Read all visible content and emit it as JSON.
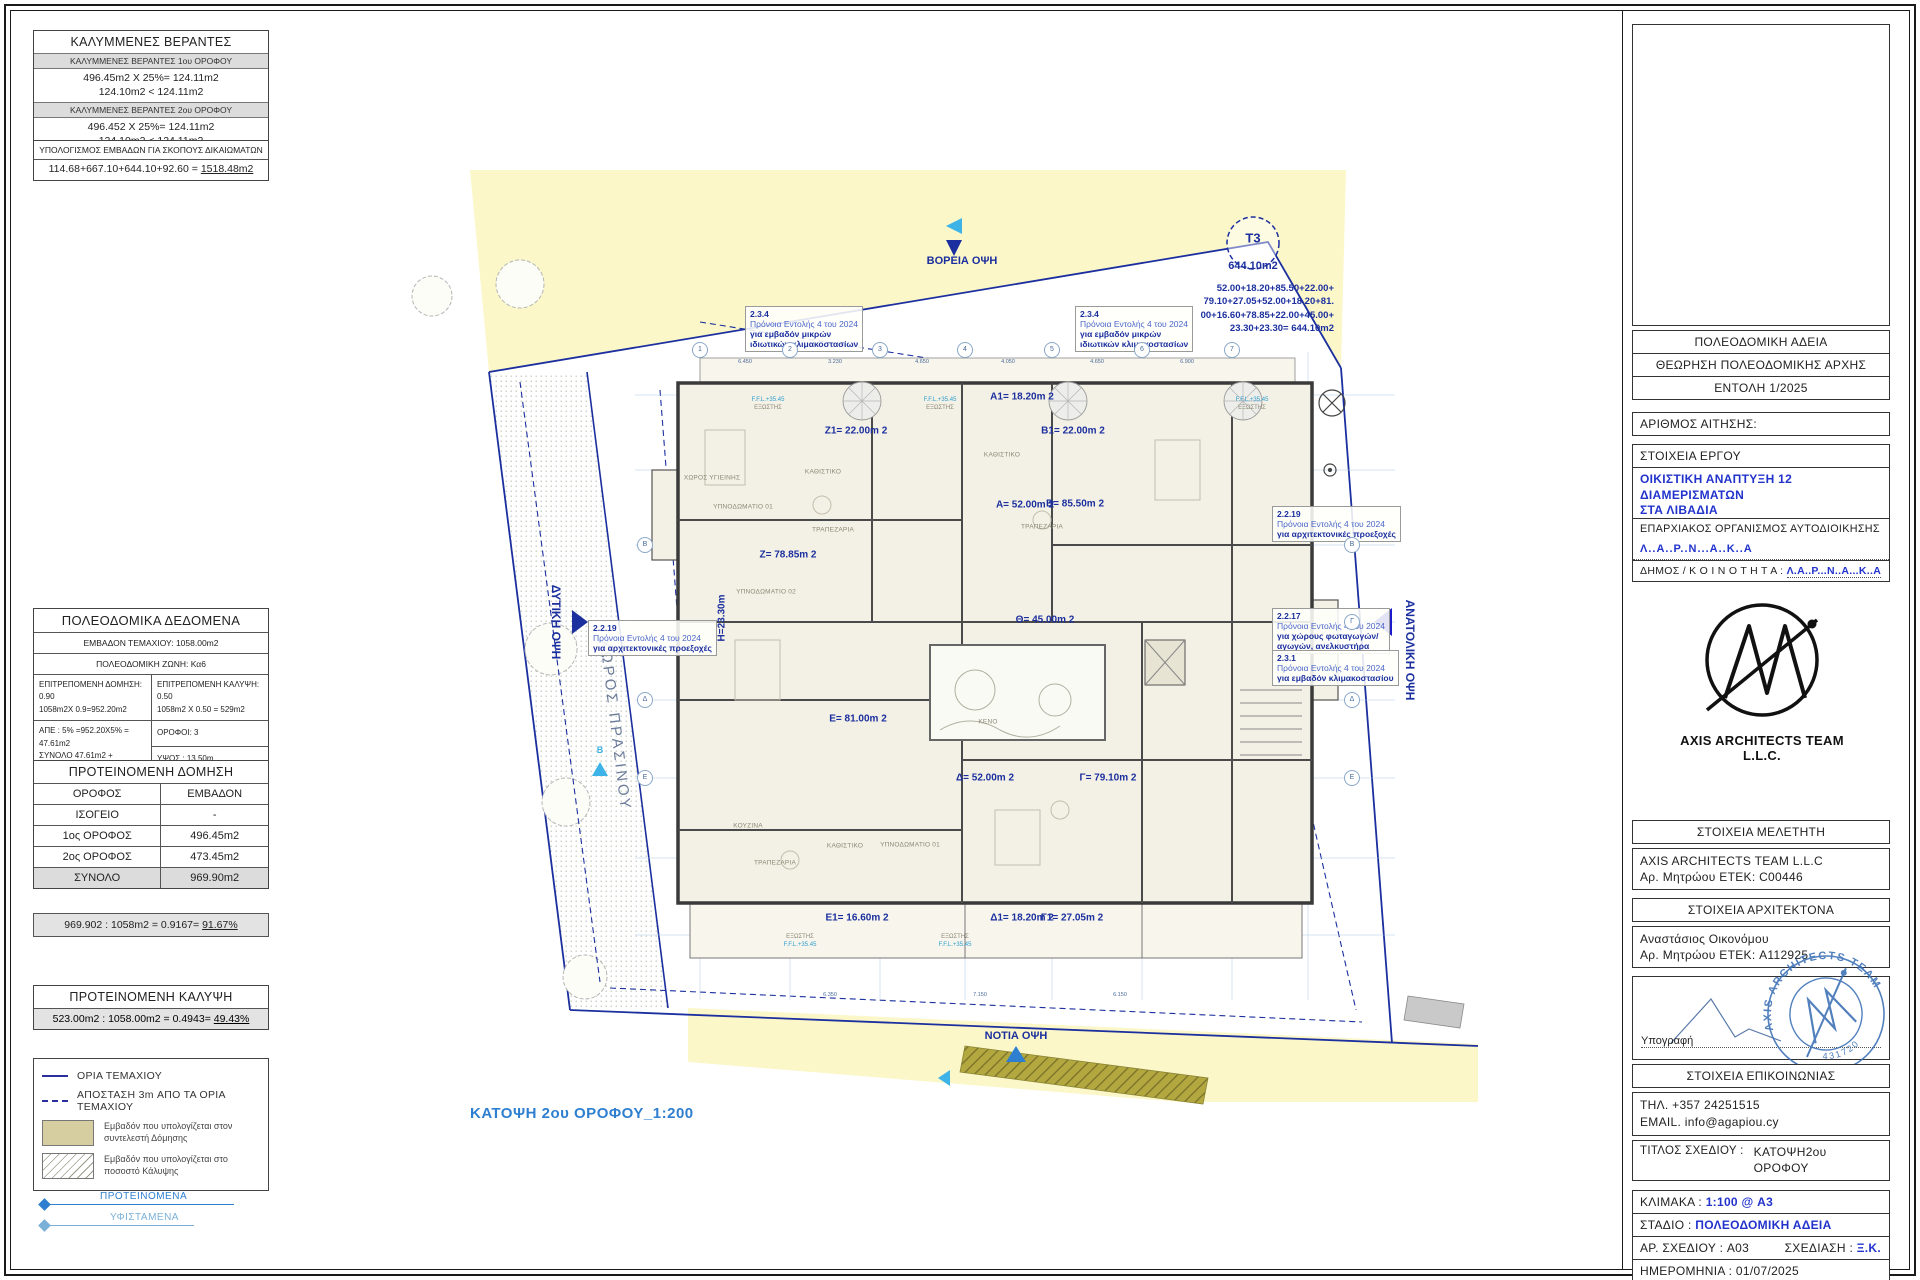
{
  "colors": {
    "navy": "#1b2f9e",
    "accent_blue": "#2233cc",
    "light_blue": "#2e7fd0",
    "cyan": "#3db3e8",
    "parcel_yellow": "#fbf7c9",
    "legend_tan": "#d6cda0",
    "header_gray": "#dcdcdc"
  },
  "left_panel": {
    "verandas": {
      "title": "ΚΑΛΥΜΜΕΝΕΣ ΒΕΡΑΝΤΕΣ",
      "s1_header": "ΚΑΛΥΜΜΕΝΕΣ ΒΕΡΑΝΤΕΣ 1ου ΟΡΟΦΟΥ",
      "s1_line1": "496.45m2 X 25%= 124.11m2",
      "s1_line2": "124.10m2 < 124.11m2",
      "s2_header": "ΚΑΛΥΜΜΕΝΕΣ ΒΕΡΑΝΤΕΣ 2ου ΟΡΟΦΟΥ",
      "s2_line1": "496.452 X 25%= 124.11m2",
      "s2_line2": "124.10m2 < 124.11m2"
    },
    "rights": {
      "title": "ΥΠΟΛΟΓΙΣΜΟΣ ΕΜΒΑΔΩΝ ΓΙΑ ΣΚΟΠΟΥΣ ΔΙΚΑΙΩΜΑΤΩΝ",
      "formula": "114.68+667.10+644.10+92.60 = ",
      "result": "1518.48m2"
    },
    "planning": {
      "title": "ΠΟΛΕΟΔΟΜΙΚΑ ΔΕΔΟΜΕΝΑ",
      "plot_area": "ΕΜΒΑΔΟΝ ΤΕΜΑΧΙΟΥ: 1058.00m2",
      "zone": "ΠΟΛΕΟΔΟΜΙΚΗ ΖΩΝΗ: Κα6",
      "density_title": "ΕΠΙΤΡΕΠΟΜΕΝΗ ΔΟΜΗΣΗ: 0.90",
      "density_calc": "1058m2X 0.9=952.20m2",
      "coverage_title": "ΕΠΙΤΡΕΠΟΜΕΝΗ ΚΑΛΥΨΗ: 0.50",
      "coverage_calc": "1058m2 X 0.50 = 529m2",
      "ape": "ΑΠΕ : 5% =952.20X5% = 47.61m2",
      "total_pre": "ΣΥΝΟΛΟ 47.61m2 + 952.20m2=",
      "total_result": "999.81m2",
      "floors": "ΟΡΟΦΟΙ: 3",
      "height": "ΥΨΟΣ : 13.50m"
    },
    "proposed_density": {
      "title": "ΠΡΟΤΕΙΝΟΜΕΝΗ ΔΟΜΗΣΗ",
      "col_floor": "ΟΡΟΦΟΣ",
      "col_area": "ΕΜΒΑΔΟΝ",
      "r1_floor": "ΙΣΟΓΕΙΟ",
      "r1_area": "-",
      "r2_floor": "1ος ΟΡΟΦΟΣ",
      "r2_area": "496.45m2",
      "r3_floor": "2ος ΟΡΟΦΟΣ",
      "r3_area": "473.45m2",
      "r4_floor": "ΣΥΝΟΛΟ",
      "r4_area": "969.90m2"
    },
    "density_ratio": {
      "formula": "969.902 : 1058m2 = 0.9167= ",
      "result": "91.67%"
    },
    "coverage": {
      "title": "ΠΡΟΤΕΙΝΟΜΕΝΗ ΚΑΛΥΨΗ",
      "formula": "523.00m2 : 1058.00m2 = 0.4943= ",
      "result": "49.43%"
    },
    "legend": {
      "boundary": "ΟΡΙΑ ΤΕΜΑΧΙΟΥ",
      "offset": "ΑΠΟΣΤΑΣΗ 3m ΑΠΟ ΤΑ ΟΡΙΑ ΤΕΜΑΧΙΟΥ",
      "density_l1": "Εμβαδόν που υπολογίζεται στον",
      "density_l2": "συντελεστή Δόμησης",
      "coverage_l1": "Εμβαδόν που υπολογίζεται στο",
      "coverage_l2": "ποσοστό Κάλυψης",
      "proposed": "ΠΡΟΤΕΙΝΟΜΕΝΑ",
      "existing": "ΥΦΙΣΤΑΜΕΝΑ"
    }
  },
  "drawing": {
    "caption": "ΚΑΤΟΨΗ 2ου ΟΡΟΦΟΥ_1:200",
    "north": "ΒΟΡΕΙΑ ΟΨΗ",
    "south": "ΝΟΤΙΑ ΟΨΗ",
    "west": "ΔΥΤΙΚΗ ΟΨΗ",
    "east": "ΑΝΑΤΟΛΙΚΗ ΟΨΗ",
    "green": "ΧΩΡΟΣ ΠΡΑΣΙΝΟΥ",
    "b_marker": "B",
    "t3": {
      "code": "T3",
      "area": "644.10m2",
      "sum1": "52.00+18.20+85.50+22.00+",
      "sum2": "79.10+27.05+52.00+18.20+81.",
      "sum3": "00+16.60+78.85+22.00+45.00+",
      "sum4": "23.30+23.30= 644.10m2"
    },
    "notes": {
      "n234": {
        "code": "2.3.4",
        "l1": "Πρόνοια Εντολής 4 του 2024",
        "l2": "για εμβαδόν μικρών",
        "l3": "ιδιωτικών κλιμακοστασίων"
      },
      "n2219": {
        "code": "2.2.19",
        "l1": "Πρόνοια Εντολής 4 του 2024",
        "l2": "για αρχιτεκτονικές προεξοχές"
      },
      "n2217": {
        "code": "2.2.17",
        "l1": "Πρόνοια Εντολής 4 του 2024",
        "l2": "για χώρους φωταγωγών/",
        "l3": "αγωγών, ανελκυστήρα"
      },
      "n231": {
        "code": "2.3.1",
        "l1": "Πρόνοια Εντολής 4 του 2024",
        "l2": "για εμβαδόν κλιμακοστασίου"
      }
    },
    "apartments": {
      "z1": "Z1= 22.00m 2",
      "a1": "A1= 18.20m 2",
      "b1": "B1= 22.00m 2",
      "a": "A= 52.00m 2",
      "b": "B= 85.50m 2",
      "z": "Z= 78.85m 2",
      "h": "Η=23.30m",
      "theta": "Θ= 45.00m 2",
      "e": "E= 81.00m 2",
      "d": "Δ= 52.00m 2",
      "g": "Γ= 79.10m 2",
      "e1": "E1= 16.60m 2",
      "d1": "Δ1= 18.20m 2",
      "g1": "Γ1= 27.05m 2"
    },
    "rooms": [
      "ΚΑΘΙΣΤΙΚΟ",
      "ΤΡΑΠΕΖΑΡΙΑ",
      "ΥΠΝΟΔΩΜΑΤΙΟ 01",
      "ΧΩΡΟΣ ΥΓΙΕΙΝΗΣ",
      "ΚΑΘΙΣΤΙΚΟ",
      "ΤΡΑΠΕΖΑΡΙΑ",
      "ΥΠΝΟΔΩΜΑΤΙΟ 02",
      "ΚΟΥΖΙΝΑ",
      "ΤΡΑΠΕΖΑΡΙΑ",
      "ΚΑΘΙΣΤΙΚΟ",
      "ΥΠΝΟΔΩΜΑΤΙΟ 01",
      "ΚΕΝΟ"
    ],
    "ffl": "F.F.L.+35.45",
    "balcony": "ΕΞΩΣΤΗΣ",
    "axes_top": [
      "1",
      "2",
      "3",
      "4",
      "5",
      "6",
      "7"
    ],
    "axes_side": [
      "Β",
      "Γ",
      "Δ",
      "Ε"
    ],
    "dims_top": [
      "6.450",
      "3.230",
      "4.650",
      "4.050",
      "4.650",
      "6.900"
    ],
    "dims_bottom": [
      "6.350",
      "7.150",
      "6.150"
    ]
  },
  "title_block": {
    "permit": "ΠΟΛΕΟΔΟΜΙΚΗ ΑΔΕΙΑ",
    "review": "ΘΕΩΡΗΣΗ ΠΟΛΕΟΔΟΜΙΚΗΣ ΑΡΧΗΣ",
    "order": "ΕΝΤΟΛΗ 1/2025",
    "application": "ΑΡΙΘΜΟΣ ΑΙΤΗΣΗΣ:",
    "project_header": "ΣΤΟΙΧΕΙΑ ΕΡΓΟΥ",
    "project_l1": "ΟΙΚΙΣΤΙΚΗ ΑΝΑΠΤΥΞΗ 12 ΔΙΑΜΕΡΙΣΜΑΤΩΝ",
    "project_l2": "ΣΤΑ ΛΙΒΑΔΙΑ",
    "district_header": "ΕΠΑΡΧΙΑΚΟΣ ΟΡΓΑΝΙΣΜΟΣ ΑΥΤΟΔΙΟΙΚΗΣΗΣ",
    "district_value": "Λ..Α..Ρ..Ν...Α..Κ..Α",
    "municipality_label": "ΔΗΜΟΣ / Κ Ο Ι Ν Ο Τ Η Τ Α :",
    "municipality_value": "Λ.Α..Ρ...Ν..Α...Κ..Α",
    "logo_text": "AXIS ARCHITECTS TEAM L.L.C.",
    "designer_header": "ΣΤΟΙΧΕΙΑ ΜΕΛΕΤΗΤΗ",
    "designer_name": "AXIS ARCHITECTS TEAM L.L.C",
    "designer_reg": "Αρ. Μητρώου ΕΤΕΚ: C00446",
    "architect_header": "ΣΤΟΙΧΕΙΑ ΑΡΧΙΤΕΚΤΟΝΑ",
    "architect_name": "Αναστάσιος Οικονόμου",
    "architect_reg": "Αρ. Μητρώου ΕΤΕΚ: A112925",
    "signature_label": "Υπογραφή",
    "stamp_ring": "AXIS ARCHITECTS TEAM LLC",
    "stamp_number": "431720",
    "contact_header": "ΣΤΟΙΧΕΙΑ ΕΠΙΚΟΙΝΩΝΙΑΣ",
    "phone": "ΤΗΛ. +357 24251515",
    "email": "EMAIL. info@agapiou.cy",
    "drawing_title_label": "ΤΙΤΛΟΣ ΣΧΕΔΙΟΥ :",
    "drawing_title_l1": "ΚΑΤΟΨΗ2ου",
    "drawing_title_l2": "ΟΡΟΦΟΥ",
    "scale_label": "ΚΛΙΜΑΚΑ : ",
    "scale_value": "1:100 @ A3",
    "stage_label": "ΣΤΑΔΙΟ : ",
    "stage_value": "ΠΟΛΕΟΔΟΜΙΚΗ ΑΔΕΙΑ",
    "number_label": "ΑΡ. ΣΧΕΔΙΟΥ : ",
    "number_value": "A03",
    "design_label": "ΣΧΕΔΙΑΣΗ : ",
    "design_value": "Ξ.Κ.",
    "date_label": "ΗΜΕΡΟΜΗΝΙΑ : ",
    "date_value": "01/07/2025"
  }
}
